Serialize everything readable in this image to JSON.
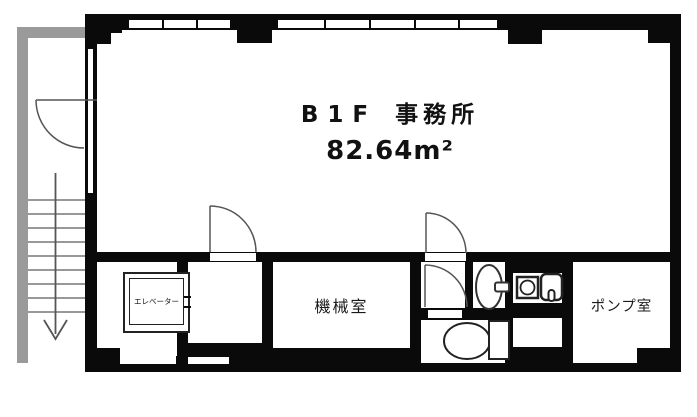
{
  "plan": {
    "title": {
      "floor_label": "B1F",
      "use_label": "事務所",
      "area_label": "82.64m²"
    },
    "rooms": {
      "machine_room_label": "機械室",
      "pump_room_label": "ポンプ室",
      "elevator_label": "エレベーター"
    },
    "stairs": {
      "direction": "down"
    },
    "colors": {
      "wall_black": "#0a0a0a",
      "exterior_gray": "#9a9a9a",
      "line_gray": "#555555"
    }
  }
}
